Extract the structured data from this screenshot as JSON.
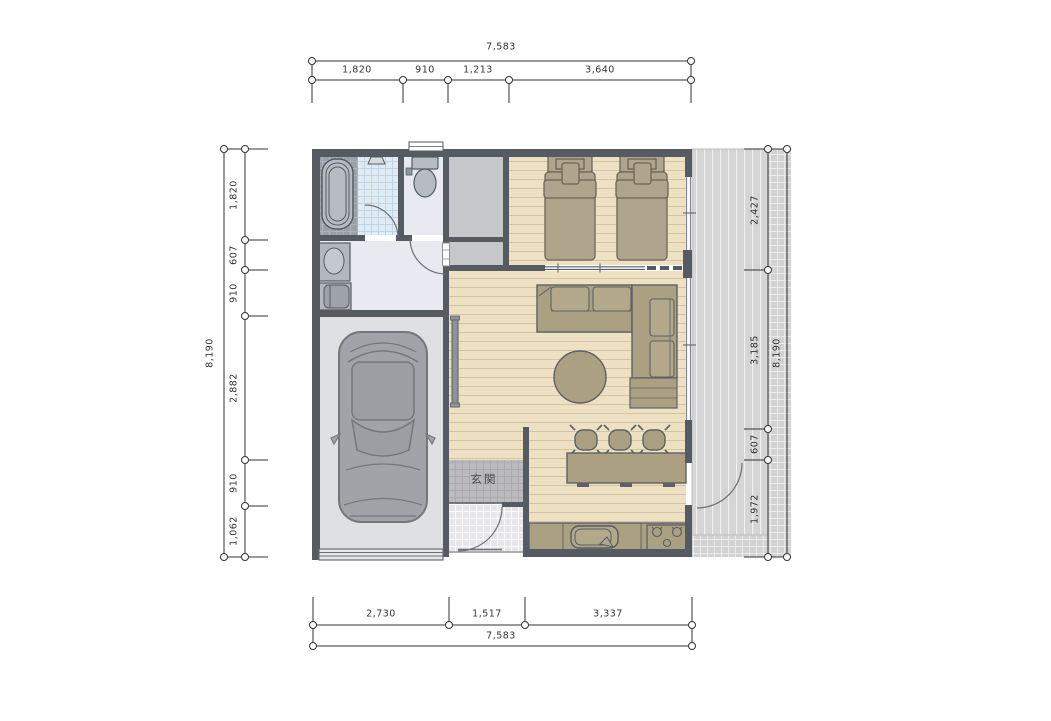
{
  "labels": {
    "entrance": "玄関"
  },
  "dimensions": {
    "top": {
      "total": "7,583",
      "segments": [
        "1,820",
        "910",
        "1,213",
        "3,640"
      ]
    },
    "bottom": {
      "total": "7,583",
      "segments": [
        "2,730",
        "1,517",
        "3,337"
      ]
    },
    "left": {
      "total": "8,190",
      "segments": [
        "1,820",
        "607",
        "910",
        "2,882",
        "910",
        "1,062"
      ]
    },
    "right": {
      "total": "8,190",
      "segments": [
        "2,427",
        "3,185",
        "607",
        "1,972"
      ]
    }
  },
  "colors": {
    "wall": "#565b62",
    "wood_floor": "#eee1c3",
    "wood_plank_line": "#d2c5a4",
    "furniture_tan": "#aba081",
    "bed_tan": "#b0a48c",
    "bath_tile_grey": "#9aa1a9",
    "shower_tile_blue": "#e0eaf3",
    "hall_floor": "#e9eaf1",
    "closet_grey": "#c6c7c9",
    "garage_floor": "#dfe0e1",
    "genkan_tile": "#bbbbbf",
    "porch_tile": "#e6e6e8",
    "deck_grey": "#d5d5d5",
    "apron_grey": "#d2d2d2",
    "dim_line": "#333333"
  }
}
